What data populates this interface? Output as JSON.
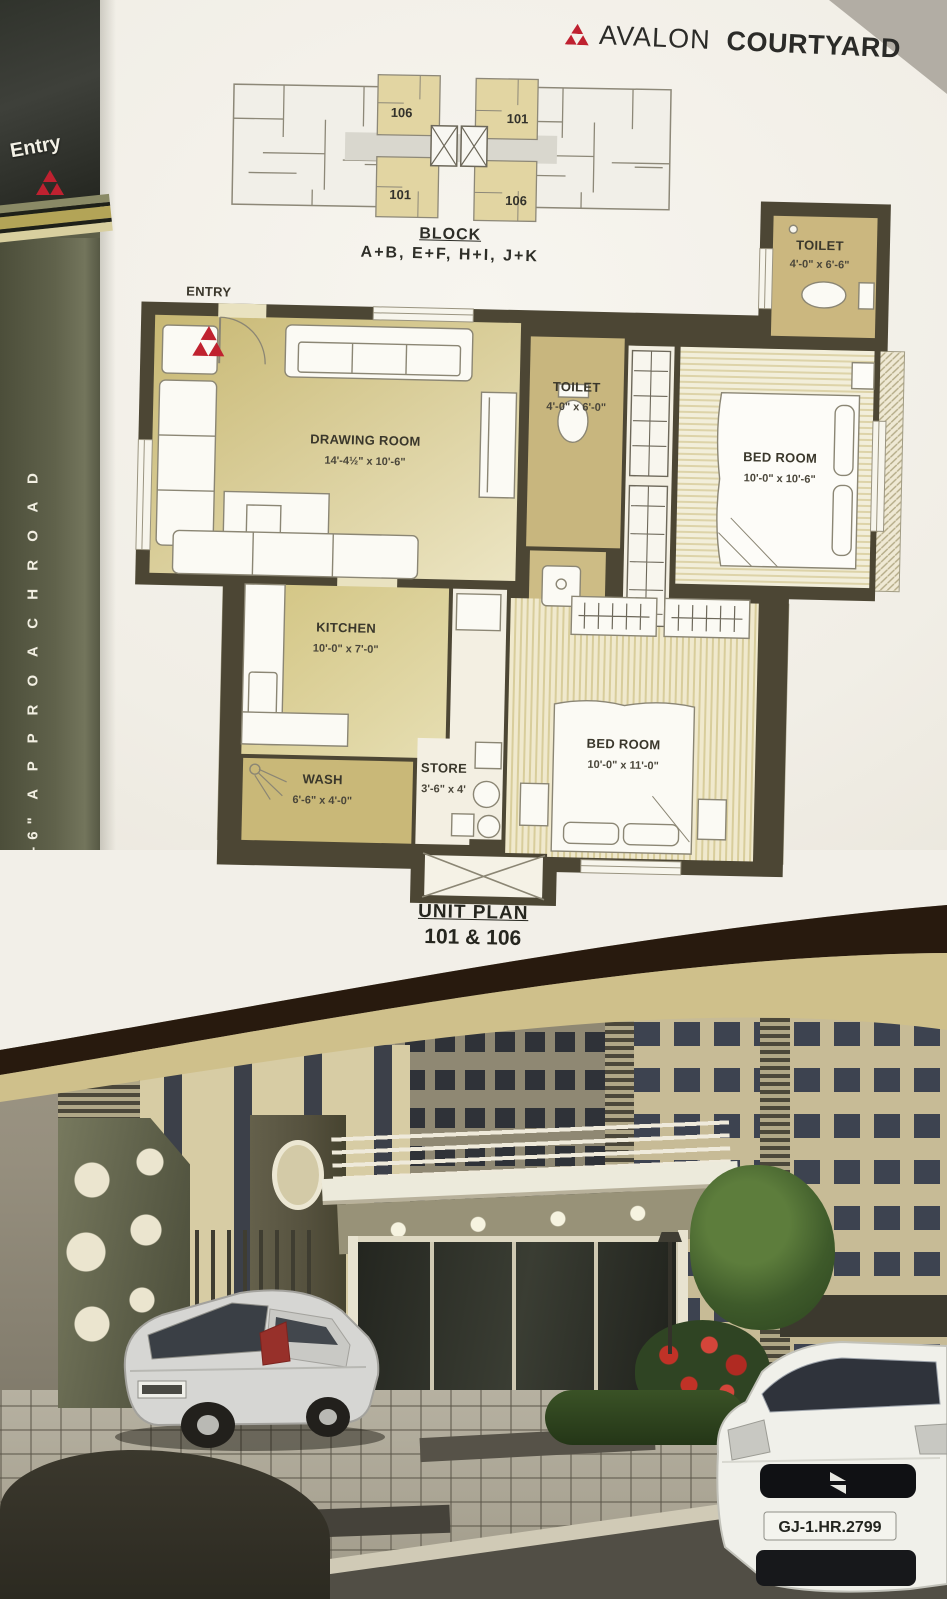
{
  "brand": {
    "name_a": "AVALON",
    "name_b": "COURTYARD"
  },
  "left_panel": {
    "entry": "Entry",
    "road": "29'-6\"  A P P R O A C H   R O A D"
  },
  "block_plan": {
    "caption_title": "BLOCK",
    "caption_blocks": "A+B,  E+F,  H+I,  J+K",
    "unit_tl": "106",
    "unit_tr": "101",
    "unit_bl": "101",
    "unit_br": "106"
  },
  "floor_plan": {
    "entry": "ENTRY",
    "toilet_top": {
      "name": "TOILET",
      "dims": "4'-0\" x 6'-6\""
    },
    "toilet_mid": {
      "name": "TOILET",
      "dims": "4'-0\" x 6'-0\""
    },
    "drawing": {
      "name": "DRAWING ROOM",
      "dims": "14'-4½\" x 10'-6\""
    },
    "bed1": {
      "name": "BED ROOM",
      "dims": "10'-0\" x 10'-6\""
    },
    "kitchen": {
      "name": "KITCHEN",
      "dims": "10'-0\" x 7'-0\""
    },
    "wash": {
      "name": "WASH",
      "dims": "6'-6\" x 4'-0\""
    },
    "store": {
      "name": "STORE",
      "dims": "3'-6\" x 4'"
    },
    "bed2": {
      "name": "BED ROOM",
      "dims": "10'-0\" x 11'-0\""
    }
  },
  "unit_plan": {
    "title": "UNIT PLAN",
    "units": "101 & 106"
  },
  "photo": {
    "license_plate": "GJ-1.HR.2799"
  },
  "colors": {
    "logo_red": "#bf2130",
    "wall": "#4c4634",
    "room_tan": "#d8c98c",
    "panel_olive": "#5d5f49",
    "band_dark": "#2a1c10",
    "band_tan": "#cfc08b"
  }
}
